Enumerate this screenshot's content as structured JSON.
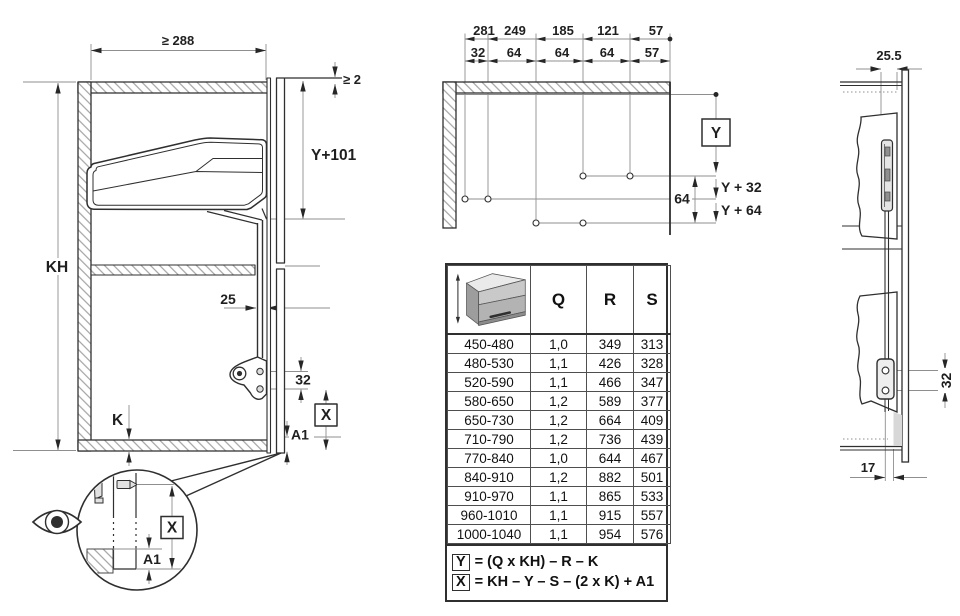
{
  "left_view": {
    "width_min": "≥ 288",
    "top_gap": "≥ 2",
    "drive_bottom": "Y+101",
    "cabinet_height": "KH",
    "arm_clearance": "25",
    "screw_spacing": "32",
    "board_thickness": "K",
    "x_label": "X",
    "a1_label": "A1"
  },
  "drilling_view": {
    "dist_from_front": [
      "281",
      "249",
      "185",
      "121",
      "57"
    ],
    "hole_pitch": [
      "32",
      "64",
      "64",
      "64",
      "57"
    ],
    "y_label": "Y",
    "row_gap": "64",
    "row2_label": "Y + 32",
    "row3_label": "Y + 64"
  },
  "table": {
    "col_headers": [
      "Q",
      "R",
      "S"
    ],
    "rows": [
      {
        "range": "450-480",
        "q": "1,0",
        "r": "349",
        "s": "313"
      },
      {
        "range": "480-530",
        "q": "1,1",
        "r": "426",
        "s": "328"
      },
      {
        "range": "520-590",
        "q": "1,1",
        "r": "466",
        "s": "347"
      },
      {
        "range": "580-650",
        "q": "1,2",
        "r": "589",
        "s": "377"
      },
      {
        "range": "650-730",
        "q": "1,2",
        "r": "664",
        "s": "409"
      },
      {
        "range": "710-790",
        "q": "1,2",
        "r": "736",
        "s": "439"
      },
      {
        "range": "770-840",
        "q": "1,0",
        "r": "644",
        "s": "467"
      },
      {
        "range": "840-910",
        "q": "1,2",
        "r": "882",
        "s": "501"
      },
      {
        "range": "910-970",
        "q": "1,1",
        "r": "865",
        "s": "533"
      },
      {
        "range": "960-1010",
        "q": "1,1",
        "r": "915",
        "s": "557"
      },
      {
        "range": "1000-1040",
        "q": "1,1",
        "r": "954",
        "s": "576"
      }
    ],
    "formulas": [
      {
        "box": "Y",
        "expr": "= (Q x KH) – R – K"
      },
      {
        "box": "X",
        "expr": "= KH – Y – S – (2 x K) + A1"
      }
    ]
  },
  "side_view": {
    "rail_depth": "25.5",
    "screw_spacing": "32",
    "plate_offset": "17"
  },
  "colors": {
    "line": "#2f2f2f",
    "dim": "#8f8f8f",
    "text": "#1f1f1f",
    "hatch": "#9b9b9b"
  }
}
